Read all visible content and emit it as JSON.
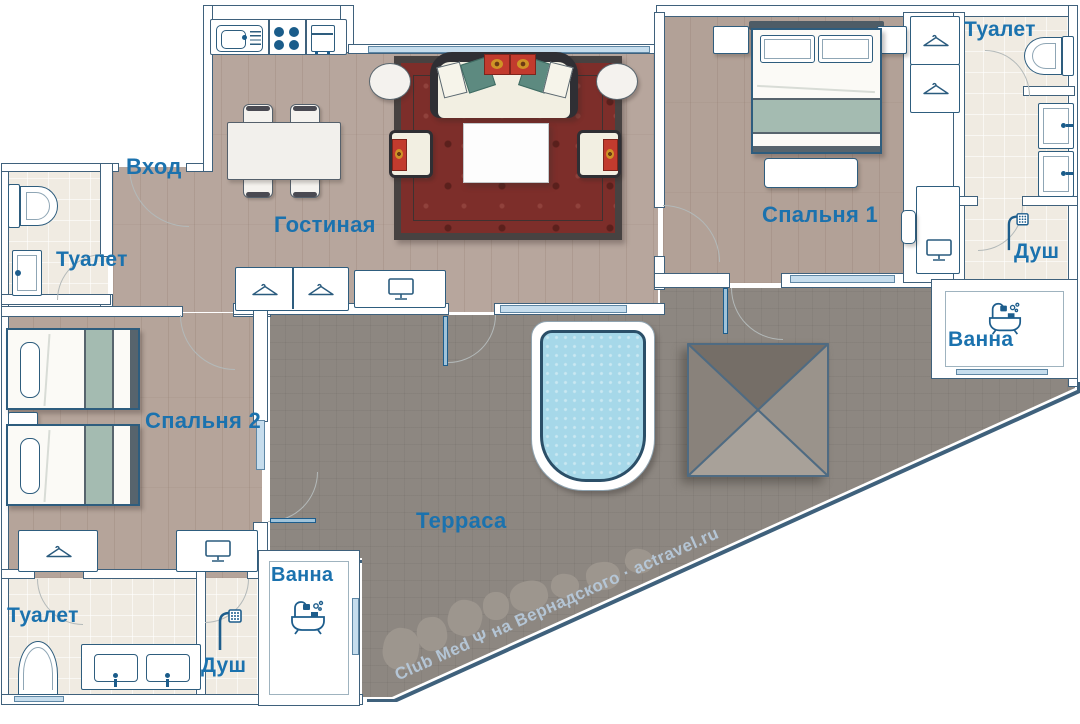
{
  "plan": {
    "kind": "apartment floor plan",
    "language": "ru"
  },
  "rooms": {
    "entrance": {
      "label": "Вход"
    },
    "living_room": {
      "label": "Гостиная"
    },
    "bedroom_1": {
      "label": "Спальня 1"
    },
    "bedroom_2": {
      "label": "Спальня 2"
    },
    "terrace": {
      "label": "Терраса"
    },
    "toilet_left": {
      "label": "Туалет"
    },
    "toilet_top_right": {
      "label": "Туалет"
    },
    "toilet_bottom_left": {
      "label": "Туалет"
    },
    "shower_right": {
      "label": "Душ"
    },
    "shower_bottom_left": {
      "label": "Душ"
    },
    "bath_right": {
      "label": "Ванна"
    },
    "bath_bottom": {
      "label": "Ванна"
    }
  },
  "watermark": {
    "text": "Club Med Ψ на Вернадского · actravel.ru"
  },
  "icons": [
    "hanger-icon",
    "tv-icon",
    "shower-icon",
    "bathtub-icon",
    "toilet-icon",
    "sink-icon",
    "stove-icon",
    "fridge-icon",
    "kitchen-sink-icon"
  ],
  "colors": {
    "label_blue": "#1b72ae",
    "wall_outline": "#3f617c",
    "furniture_outline": "#2e5d7e",
    "wood_floor": "#b7a69d",
    "tile_floor": "#f0ebe2",
    "terrace_gray": "#8d8781",
    "pool_water": "#a6d8e9",
    "carpet_red": "#7d2e2a",
    "pillow_teal": "#5d8a80",
    "pillow_red": "#c23b2e",
    "bed_stripe_teal": "#a4bbb1"
  }
}
